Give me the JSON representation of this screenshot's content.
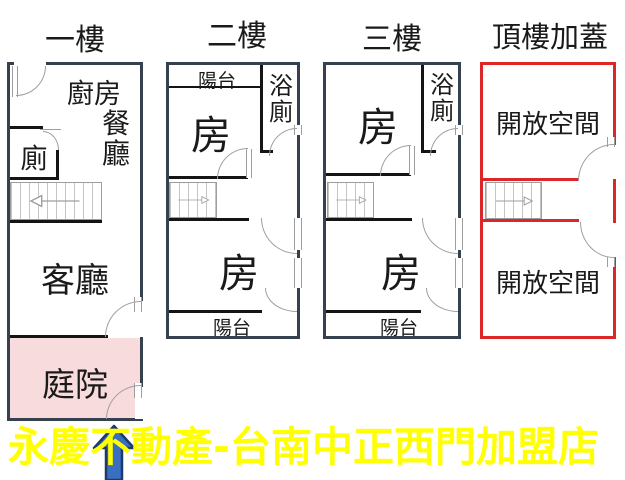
{
  "colors": {
    "wall": "#36414F",
    "partition": "#141414",
    "red": "#DB2727",
    "pink": "#F8DBDC",
    "yellow": "#FFFF00",
    "blue": "#3A6EC0",
    "blue_dark": "#1C3A6B",
    "door": "#9E9E9E",
    "ink": "#1A1A1A",
    "stair_line": "#C4C4C4"
  },
  "floors": {
    "f1": {
      "title": "一樓",
      "kitchen": "廚房",
      "dining": "餐廳",
      "toilet": "廁",
      "living": "客廳",
      "yard": "庭院"
    },
    "f2": {
      "title": "二樓",
      "balcony_top": "陽台",
      "bath": "浴廁",
      "room_upper": "房",
      "room_lower": "房",
      "balcony_bottom": "陽台"
    },
    "f3": {
      "title": "三樓",
      "bath": "浴廁",
      "room_upper": "房",
      "room_lower": "房",
      "balcony_bottom": "陽台"
    },
    "roof": {
      "title": "頂樓加蓋",
      "open_upper": "開放空間",
      "open_lower": "開放空間"
    }
  },
  "banner": {
    "text": "永慶不動產-台南中正西門加盟店"
  }
}
